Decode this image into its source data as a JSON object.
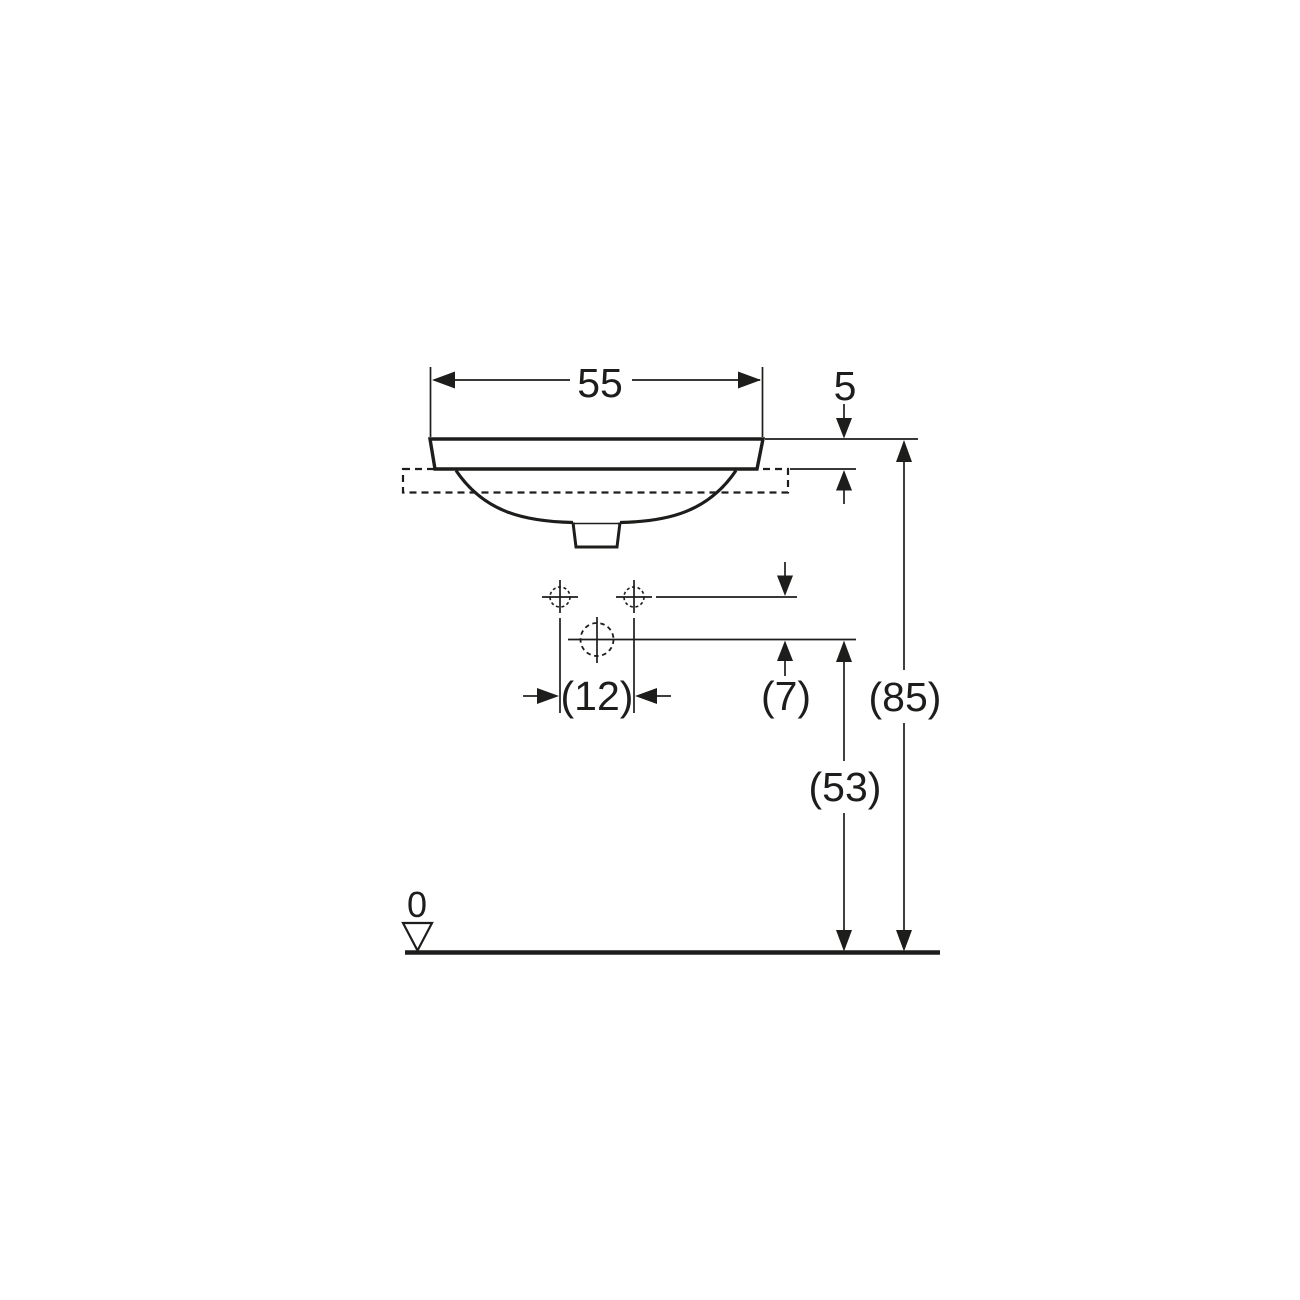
{
  "drawing": {
    "type": "technical-dimension-drawing",
    "subject": "built-in washbasin, front elevation with installation dimensions",
    "unit": "cm",
    "colors": {
      "line": "#1d1d1b",
      "background": "#ffffff"
    },
    "labels": {
      "overall_width": "55",
      "rim_height_above_counter": "5",
      "tap_hole_spacing": "(12)",
      "tap_to_outlet_offset": "(7)",
      "rim_height_above_floor": "(85)",
      "outlet_height_above_floor": "(53)",
      "datum_level": "0"
    }
  }
}
